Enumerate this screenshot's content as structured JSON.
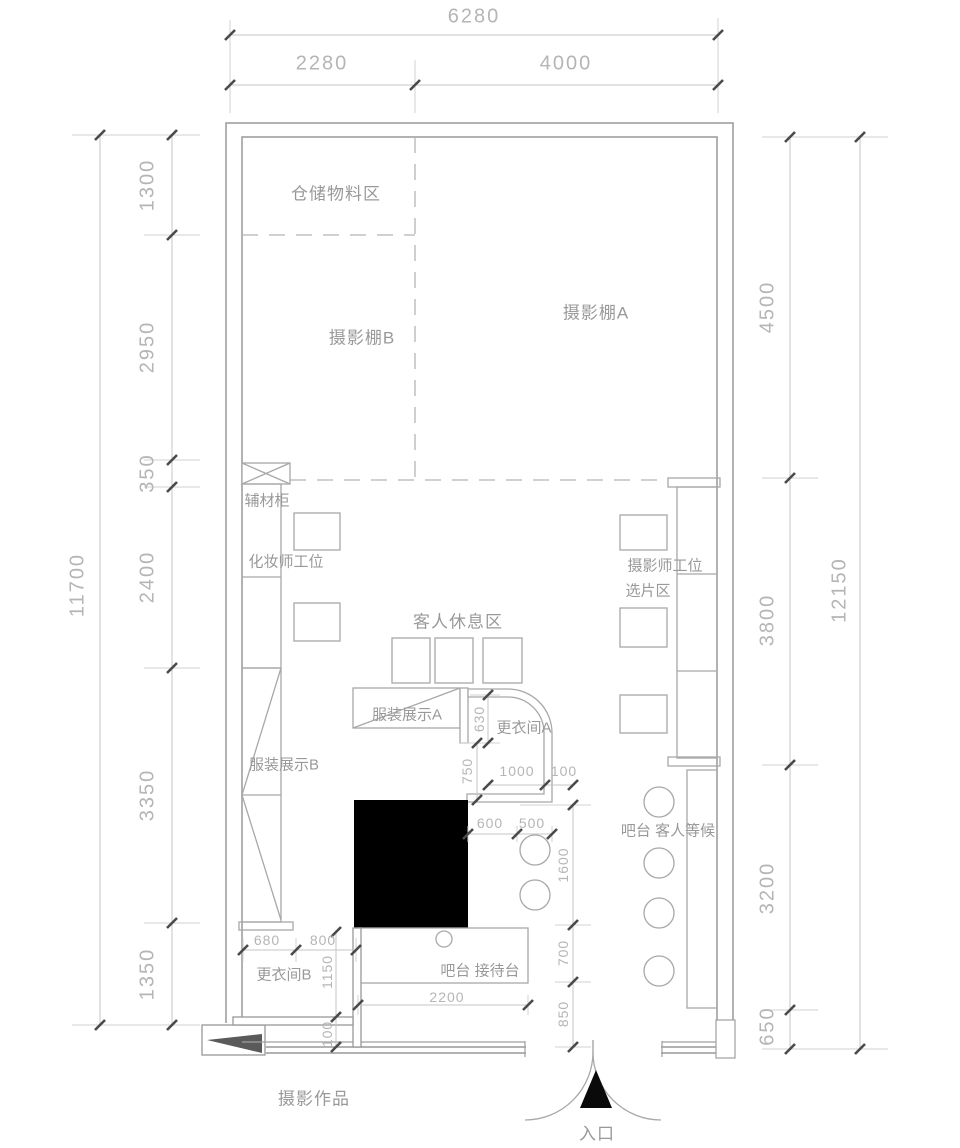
{
  "title": "摄影工作室平面布置图",
  "labels": {
    "storage": "仓储物料区",
    "studio_b": "摄影棚B",
    "studio_a": "摄影棚A",
    "aux_cabinet": "辅材柜",
    "makeup_station": "化妆师工位",
    "guest_rest": "客人休息区",
    "clothing_a": "服装展示A",
    "changing_a": "更衣间A",
    "clothing_b": "服装展示B",
    "photographer_station": "摄影师工位",
    "selection_area": "选片区",
    "bar_waiting": "吧台 客人等候",
    "changing_b": "更衣间B",
    "bar_reception": "吧台  接待台",
    "photo_works": "摄影作品",
    "entrance": "入口"
  },
  "dims": {
    "top_total": "6280",
    "top_left": "2280",
    "top_right": "4000",
    "left_total": "11700",
    "left_segs": [
      "1300",
      "2950",
      "350",
      "2400",
      "3350",
      "1350"
    ],
    "right_total": "12150",
    "right_segs": [
      "4500",
      "3800",
      "3200",
      "650"
    ],
    "interior": {
      "changing_a_h": "630",
      "door_a": "750",
      "changing_a_w": "1000",
      "wall_a": "100",
      "aisle": "600",
      "stool": "500",
      "bar_len": "1600",
      "bar_gap": "700",
      "entry_side": "850",
      "changing_b_w1": "680",
      "changing_b_w2": "800",
      "changing_b_h": "1150",
      "wall_b": "100",
      "reception_len": "2200"
    }
  },
  "colors": {
    "wall": "#9f9f9f",
    "fixture": "#a8a8a8",
    "dashed": "#b5b5b5",
    "dimline": "#c6c6c6",
    "tick": "#4a4a4a",
    "fill_black": "#000000",
    "wedge": "#5a5a5a"
  }
}
